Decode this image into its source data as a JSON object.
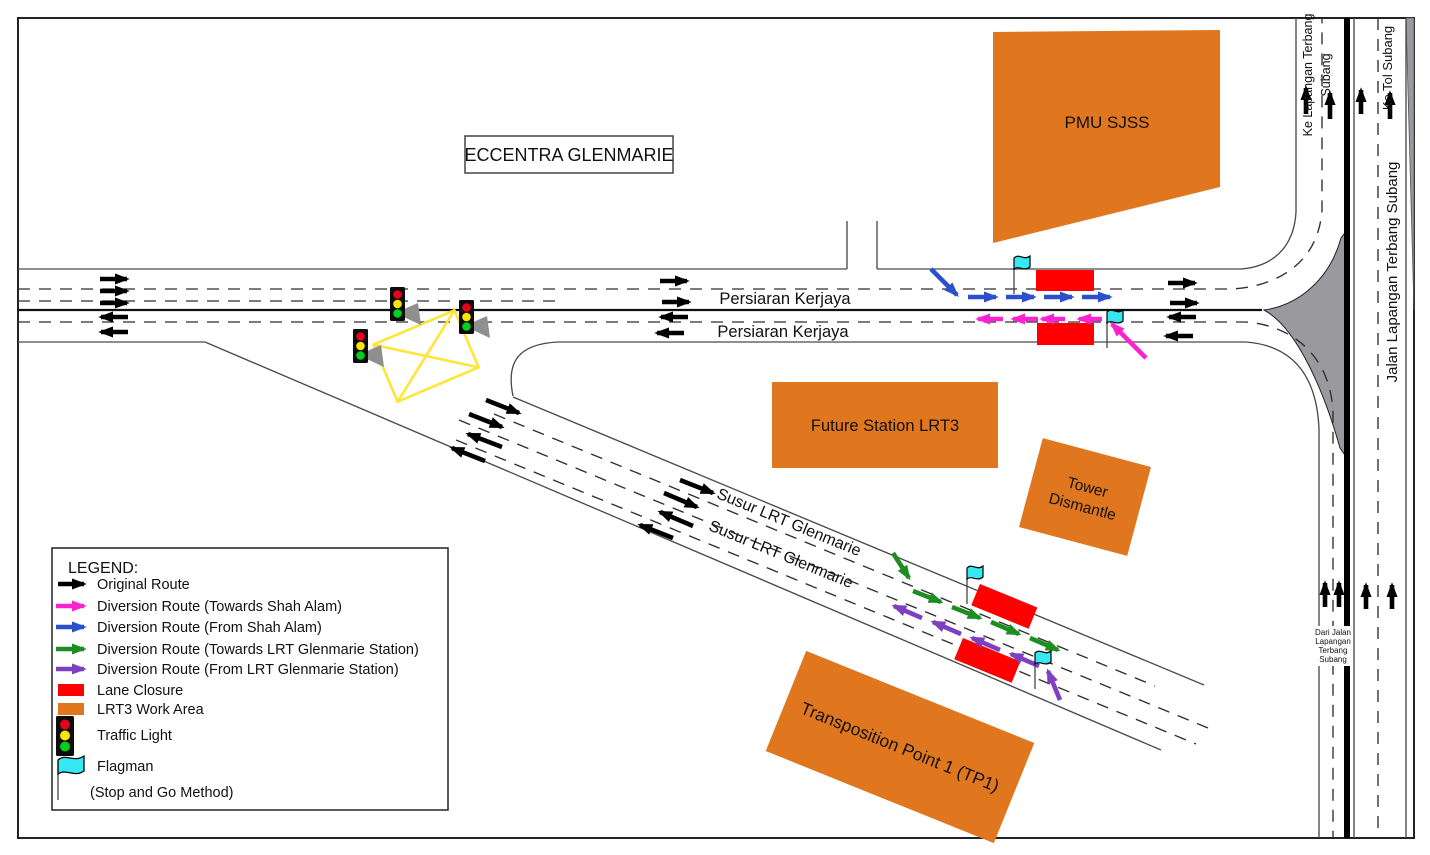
{
  "title_box": {
    "label": "ECCENTRA GLENMARIE"
  },
  "areas": {
    "pmu": "PMU SJSS",
    "future_station": "Future Station LRT3",
    "tower_line1": "Tower",
    "tower_line2": "Dismantle",
    "tp1": "Transposition Point 1 (TP1)"
  },
  "roads": {
    "pk_top": "Persiaran Kerjaya",
    "pk_bottom": "Persiaran Kerjaya",
    "susur_top": "Susur LRT Glenmarie",
    "susur_bottom": "Susur LRT Glenmarie",
    "jalan_lapangan": "Jalan Lapangan Terbang Subang",
    "ke_lapangan_l1": "Ke Lapangan Terbang",
    "ke_lapangan_l2": "Subang",
    "ke_tol": "Ke Tol Subang",
    "dari_l1": "Dari Jalan",
    "dari_l2": "Lapangan",
    "dari_l3": "Terbang",
    "dari_l4": "Subang"
  },
  "legend": {
    "title": "LEGEND:",
    "items": [
      {
        "label": "Original Route",
        "type": "arrow",
        "color": "#000000"
      },
      {
        "label": "Diversion Route (Towards Shah Alam)",
        "type": "arrow",
        "color": "#fb22d2"
      },
      {
        "label": "Diversion  Route (From Shah Alam)",
        "type": "arrow",
        "color": "#2b50cb"
      },
      {
        "label": "Diversion Route (Towards LRT Glenmarie Station)",
        "type": "arrow",
        "color": "#1e8e22"
      },
      {
        "label": "Diversion  Route (From LRT Glenmarie Station)",
        "type": "arrow",
        "color": "#7e3fc1"
      },
      {
        "label": "Lane Closure",
        "type": "rect",
        "color": "#fe0000"
      },
      {
        "label": "LRT3 Work Area",
        "type": "rect",
        "color": "#e0771e"
      },
      {
        "label": "Traffic Light",
        "type": "traffic-light"
      },
      {
        "label": "Flagman",
        "sub": "(Stop and Go Method)",
        "type": "flag"
      }
    ]
  },
  "colors": {
    "route_black": "#000000",
    "diversion_magenta": "#fb22d2",
    "diversion_blue": "#2b50cb",
    "diversion_green": "#1e8e22",
    "diversion_purple": "#7e3fc1",
    "lane_closure_red": "#fe0000",
    "work_area_orange": "#e0771e",
    "flag_cyan": "#35e8f2",
    "traffic_light_red": "#e8001d",
    "traffic_light_yellow": "#ffe400",
    "traffic_light_green": "#00cf1d",
    "junction_box_yellow": "#ffe538",
    "gore_gray": "#9a9a9e"
  }
}
